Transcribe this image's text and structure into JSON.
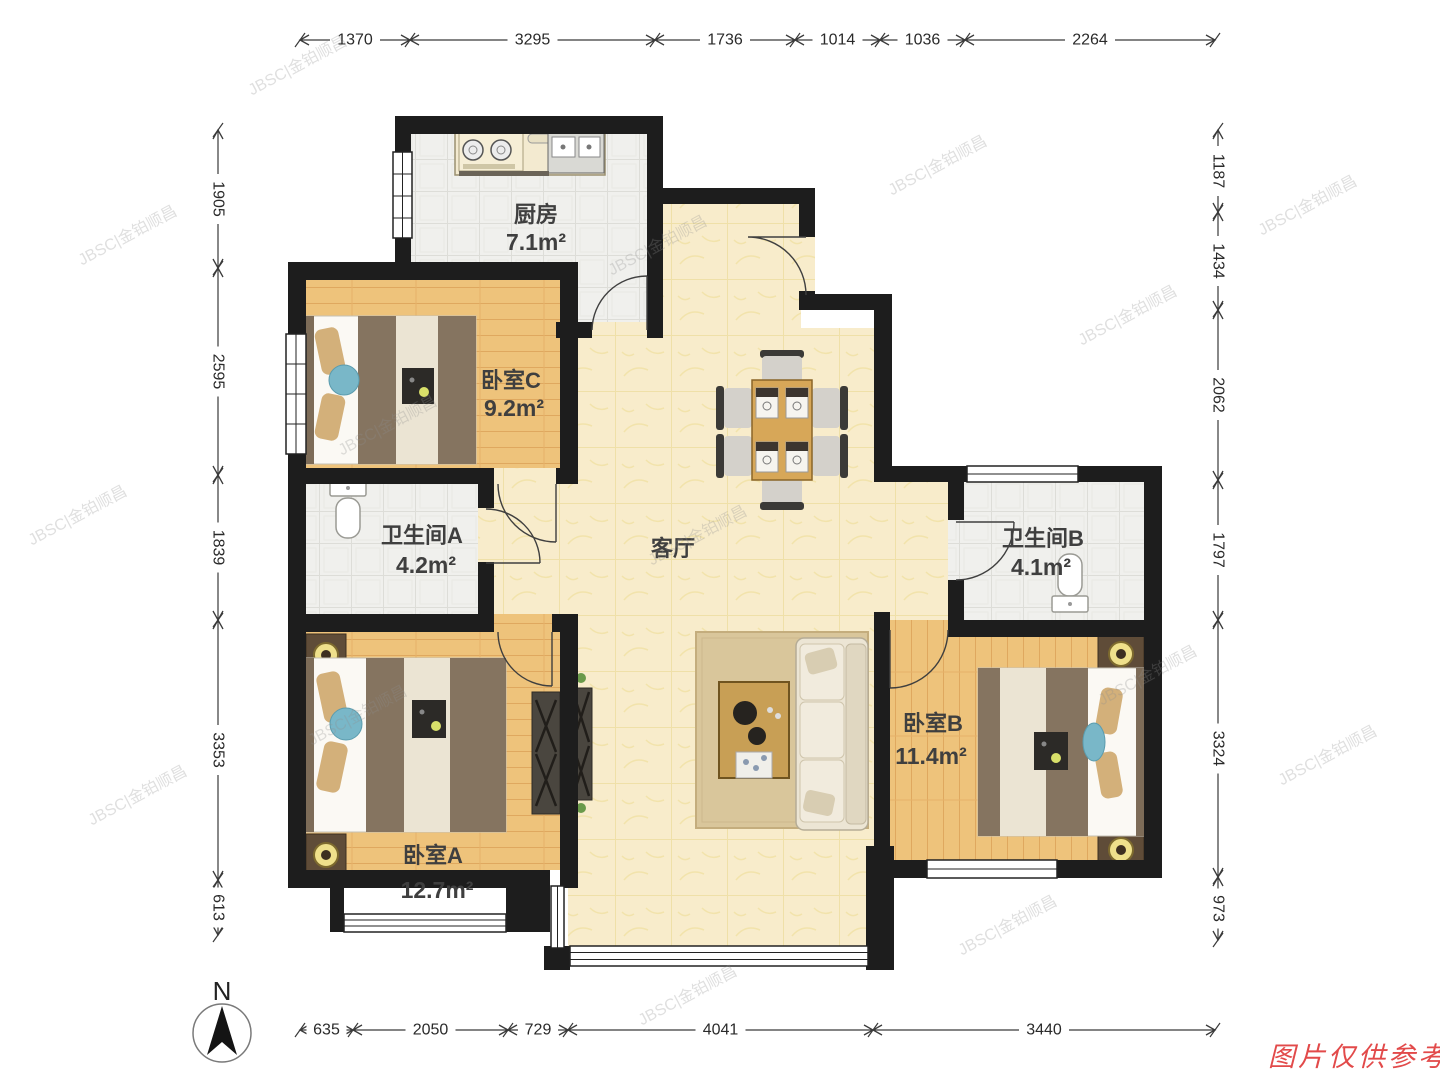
{
  "rooms": {
    "kitchen": {
      "name": "厨房",
      "area": "7.1m²"
    },
    "bedroom_c": {
      "name": "卧室C",
      "area": "9.2m²"
    },
    "bathroom_a": {
      "name": "卫生间A",
      "area": "4.2m²"
    },
    "living": {
      "name": "客厅"
    },
    "bathroom_b": {
      "name": "卫生间B",
      "area": "4.1m²"
    },
    "bedroom_b": {
      "name": "卧室B",
      "area": "11.4m²"
    },
    "bedroom_a": {
      "name": "卧室A",
      "area": "12.7m²"
    }
  },
  "dims": {
    "top": [
      "1370",
      "3295",
      "1736",
      "1014",
      "1036",
      "2264"
    ],
    "left": [
      "1905",
      "2595",
      "1839",
      "3353",
      "613"
    ],
    "right": [
      "1187",
      "1434",
      "2062",
      "1797",
      "3324",
      "973"
    ],
    "bottom": [
      "635",
      "2050",
      "729",
      "4041",
      "3440"
    ]
  },
  "compass_label": "N",
  "watermark": "JBSC|金铂顺昌",
  "disclaimer": "图片仅供参考",
  "colors": {
    "wall": "#1d1d1d",
    "wood_floor": "#eec37b",
    "marble_floor": "#f8eccb",
    "tile_floor": "#f0f0ed",
    "disclaimer_red": "#e24a4a"
  }
}
